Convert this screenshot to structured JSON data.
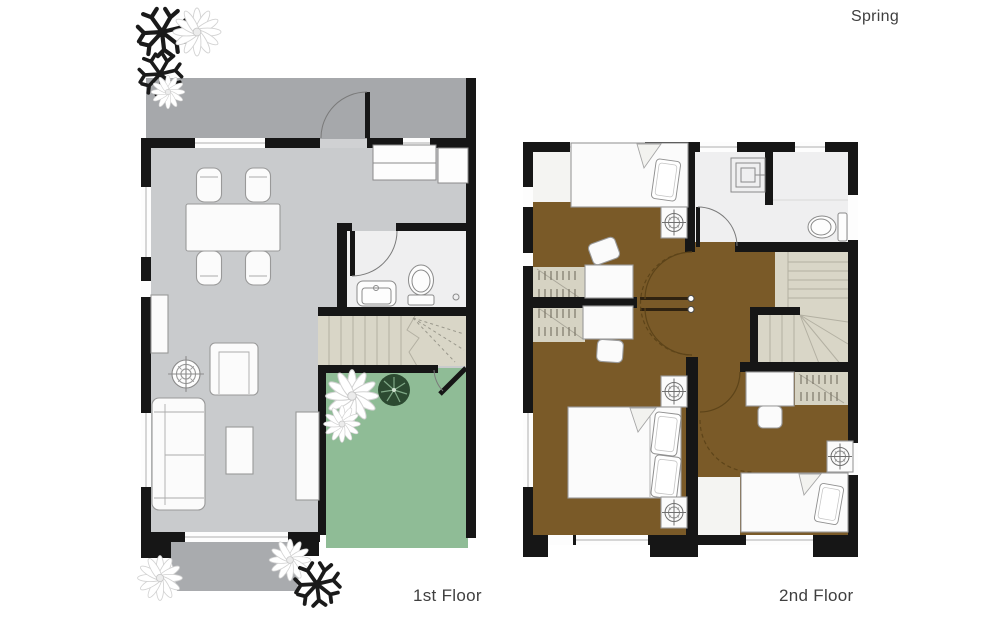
{
  "labels": {
    "brand": "Spring",
    "floor1": "1st Floor",
    "floor2": "2nd Floor"
  },
  "colors": {
    "wall": "#161616",
    "porch": "#a6a8ab",
    "living": "#c9cbcd",
    "walkway": "#a9abae",
    "bath": "#efeff0",
    "stairs": "#d9d6c7",
    "closet": "#d6d3c3",
    "patio": "#8fbc96",
    "brown": "#7a5a28",
    "furn": "#fbfbfb",
    "furnstroke": "#999999",
    "bush": "#2c4a31",
    "plant": "#1a1a1a",
    "text": "#3f3f3f"
  },
  "floor1": {
    "label": "1st Floor",
    "rooms": [
      "entry-porch",
      "living-dining-room",
      "kitchen",
      "bathroom",
      "staircase",
      "patio-garden",
      "walkway"
    ],
    "furniture": [
      "dining-table",
      "dining-chairs-x4",
      "sofa",
      "armchair",
      "coffee-table",
      "tv-console",
      "cabinet",
      "floor-medallion",
      "kitchen-counter",
      "toilet",
      "sink",
      "entry-door",
      "patio-door",
      "shrubs",
      "flowers"
    ]
  },
  "floor2": {
    "label": "2nd Floor",
    "rooms": [
      "bedroom-1",
      "master-bedroom",
      "bedroom-2",
      "bathroom",
      "staircase",
      "hallway",
      "closets-x3"
    ],
    "furniture": [
      "single-bed",
      "double-bed",
      "single-bed-2",
      "desks-x3",
      "chairs-x3",
      "nightstands-x4",
      "shower",
      "toilet",
      "doors-with-swing-arcs"
    ]
  }
}
